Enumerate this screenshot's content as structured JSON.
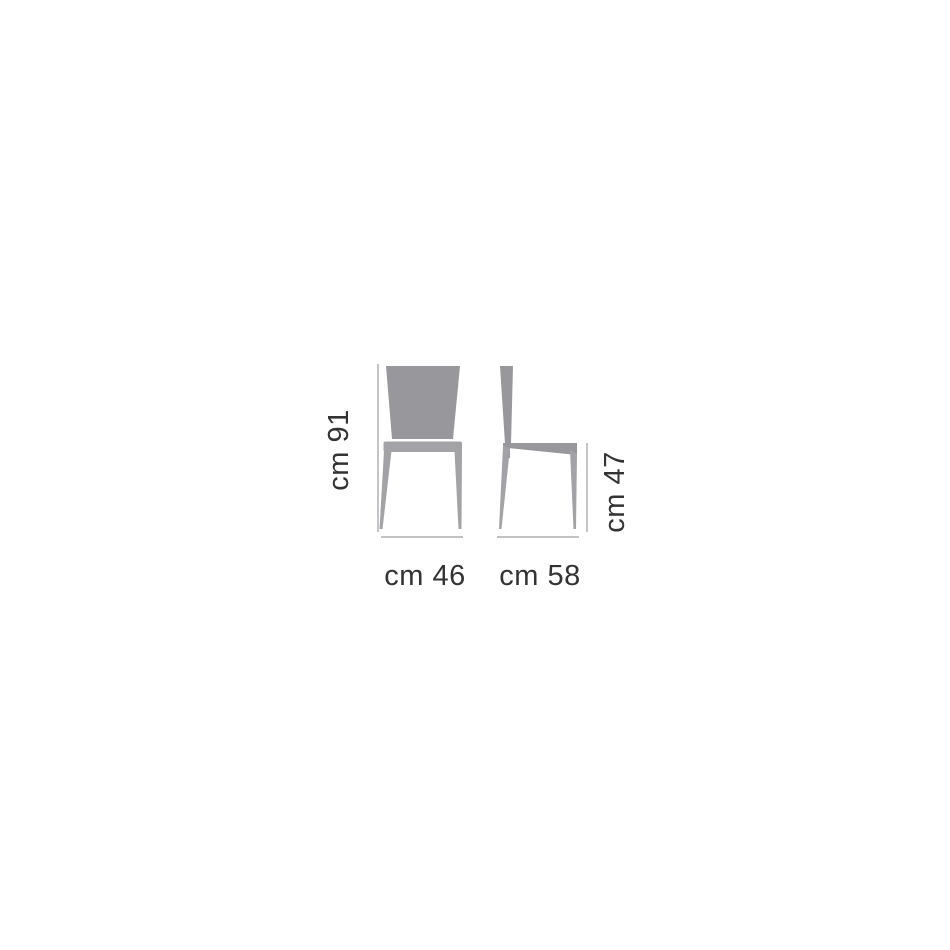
{
  "page": {
    "background_color": "#ffffff"
  },
  "diagram": {
    "kind": "chair-dimension-drawing",
    "views": [
      "front",
      "side"
    ],
    "dimensions_cm": {
      "height": 91,
      "width": 46,
      "depth": 58,
      "seat_height": 47
    },
    "labels": {
      "height": "cm 91",
      "width": "cm 46",
      "depth": "cm 58",
      "seat_height": "cm 47"
    },
    "colors": {
      "chair_fill": "#98989c",
      "chair_fill_light": "#a3a3a7",
      "dimension_line": "#9e9e9e",
      "label_text": "#333333"
    }
  }
}
